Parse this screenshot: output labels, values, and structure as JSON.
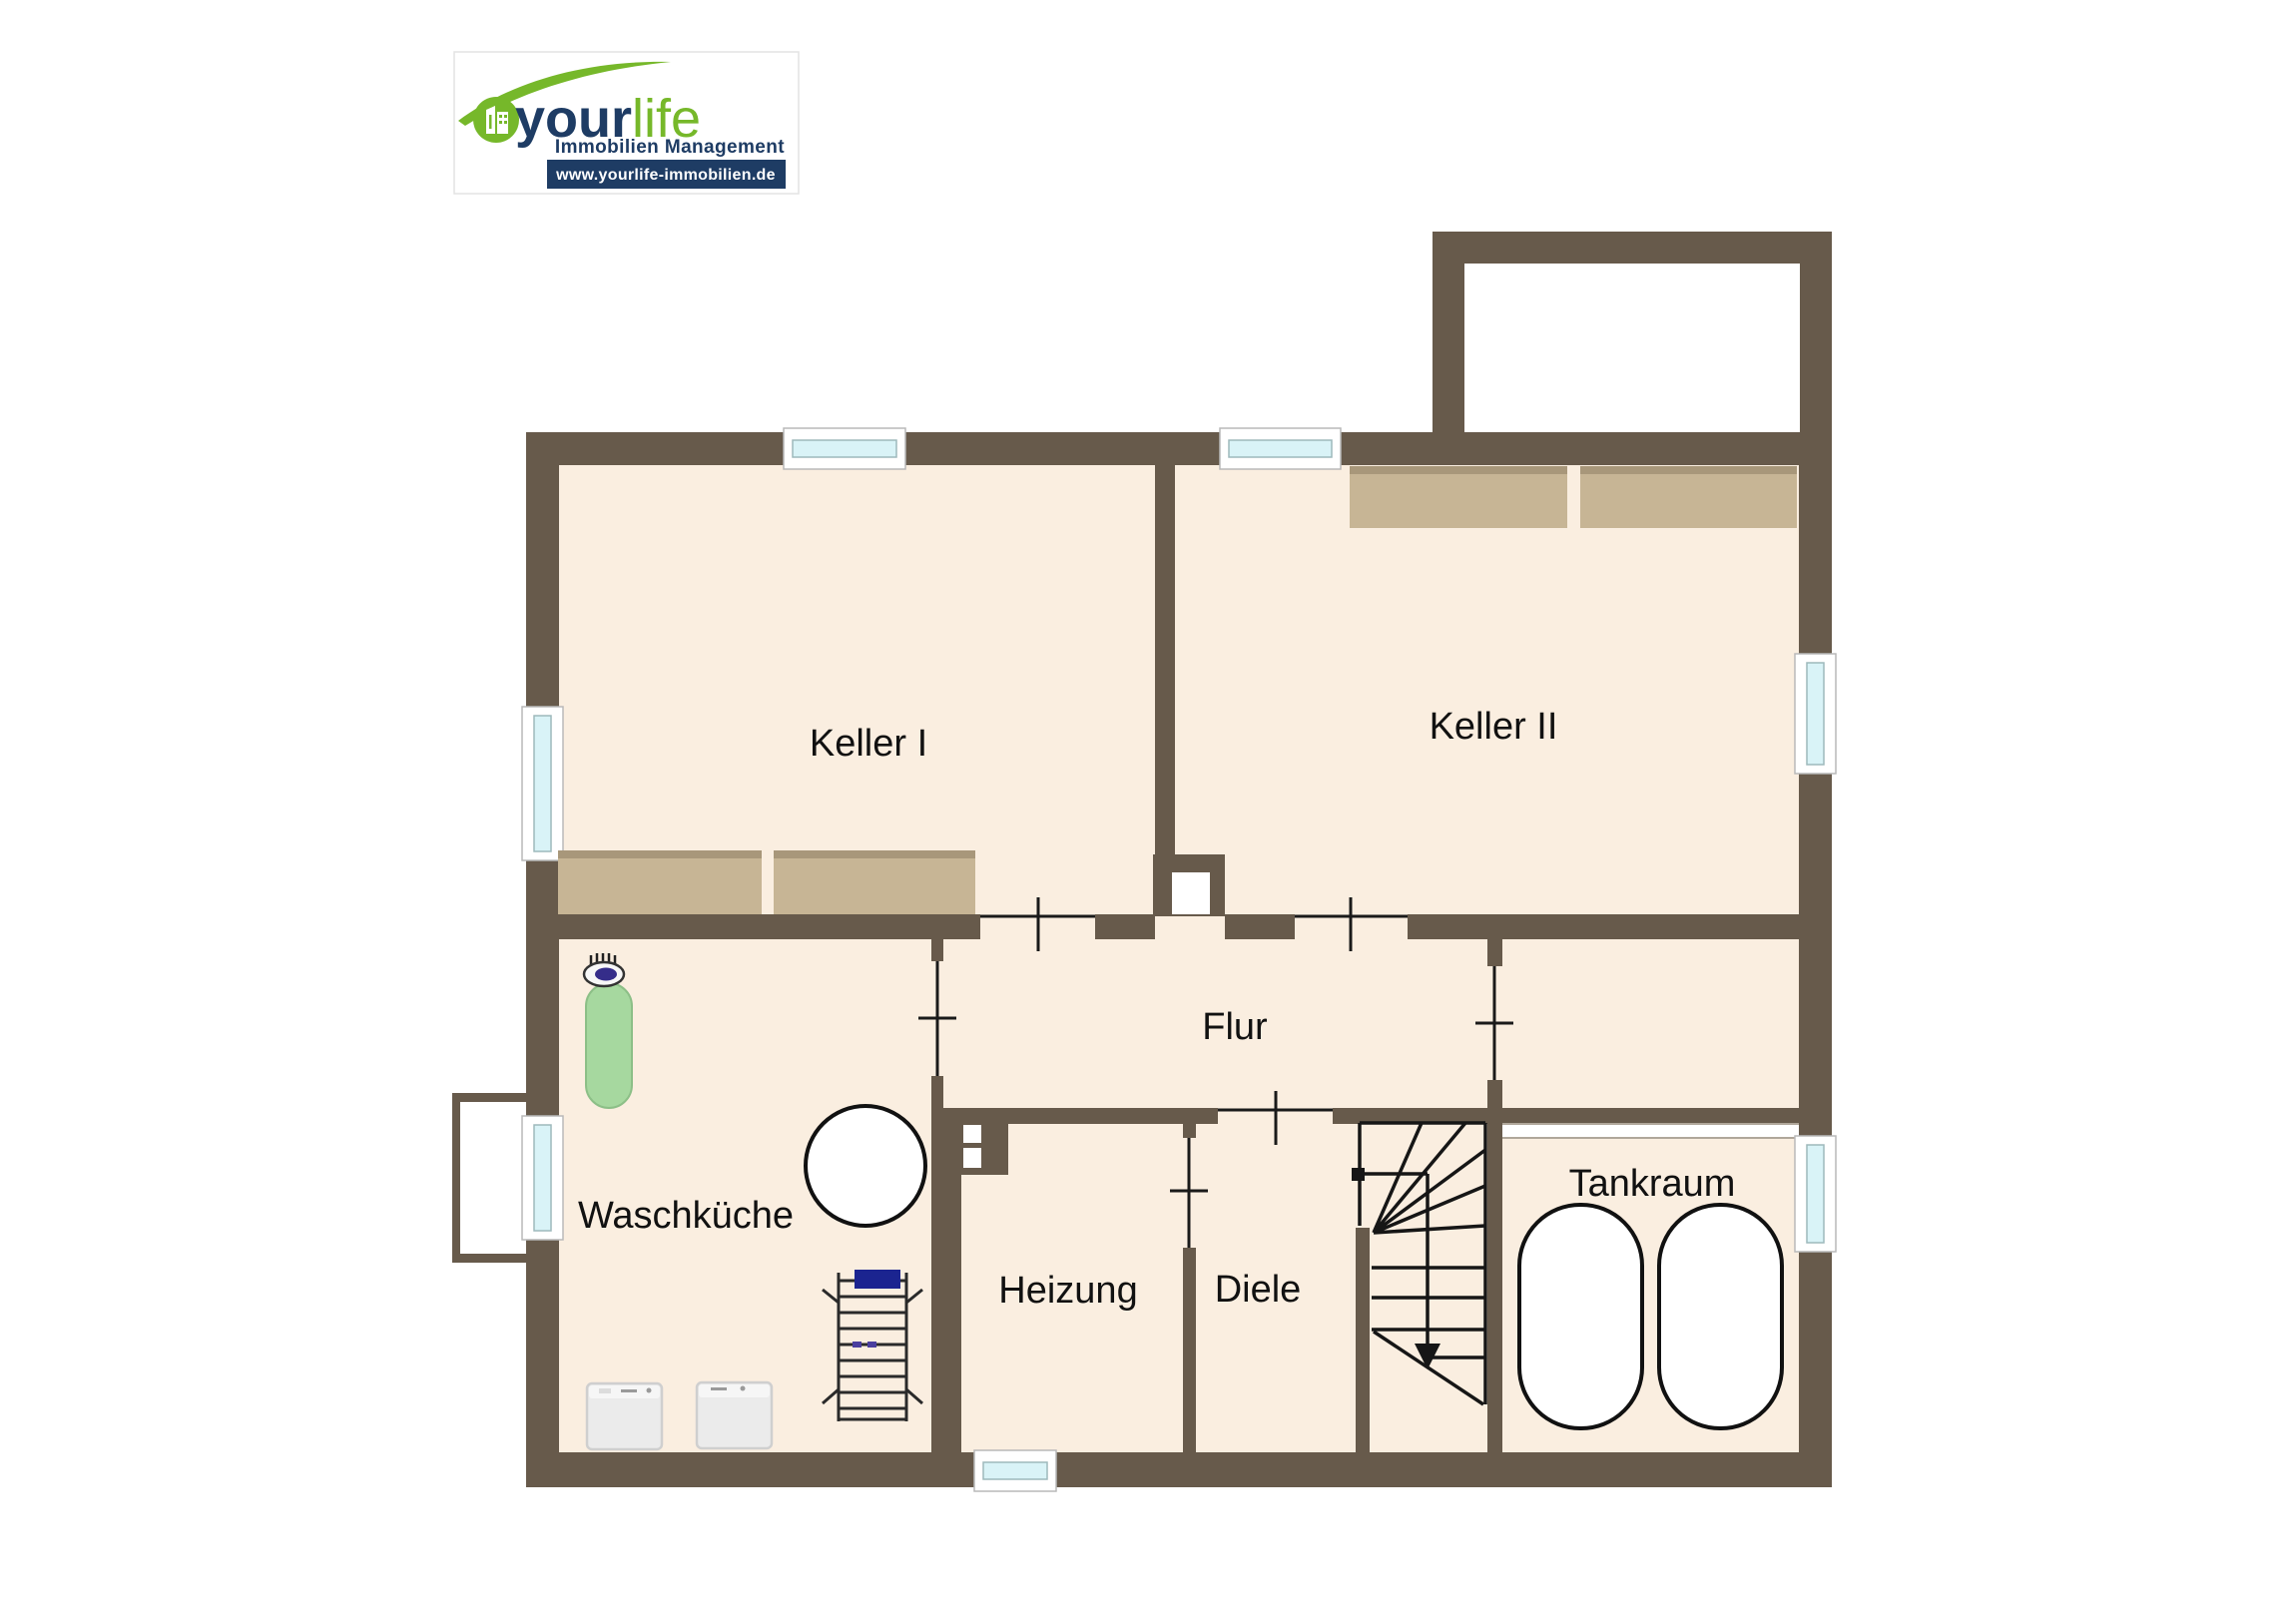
{
  "logo": {
    "brand_your": "your",
    "brand_life": "life",
    "subtitle": "Immobilien Management",
    "website": "www.yourlife-immobilien.de"
  },
  "rooms": {
    "keller1": {
      "label": "Keller I"
    },
    "keller2": {
      "label": "Keller II"
    },
    "flur": {
      "label": "Flur"
    },
    "waschkueche": {
      "label": "Waschküche"
    },
    "heizung": {
      "label": "Heizung"
    },
    "diele": {
      "label": "Diele"
    },
    "tankraum": {
      "label": "Tankraum"
    }
  },
  "colors": {
    "wall": "#675a4b",
    "floor": "#faeee0",
    "window_glass": "#d9f3f7",
    "shelf_wood": "#c7b595",
    "ironing_board_green": "#a6d89f",
    "towel_navy": "#1b2490",
    "logo_green": "#76b82a",
    "logo_navy": "#1e3c64"
  }
}
